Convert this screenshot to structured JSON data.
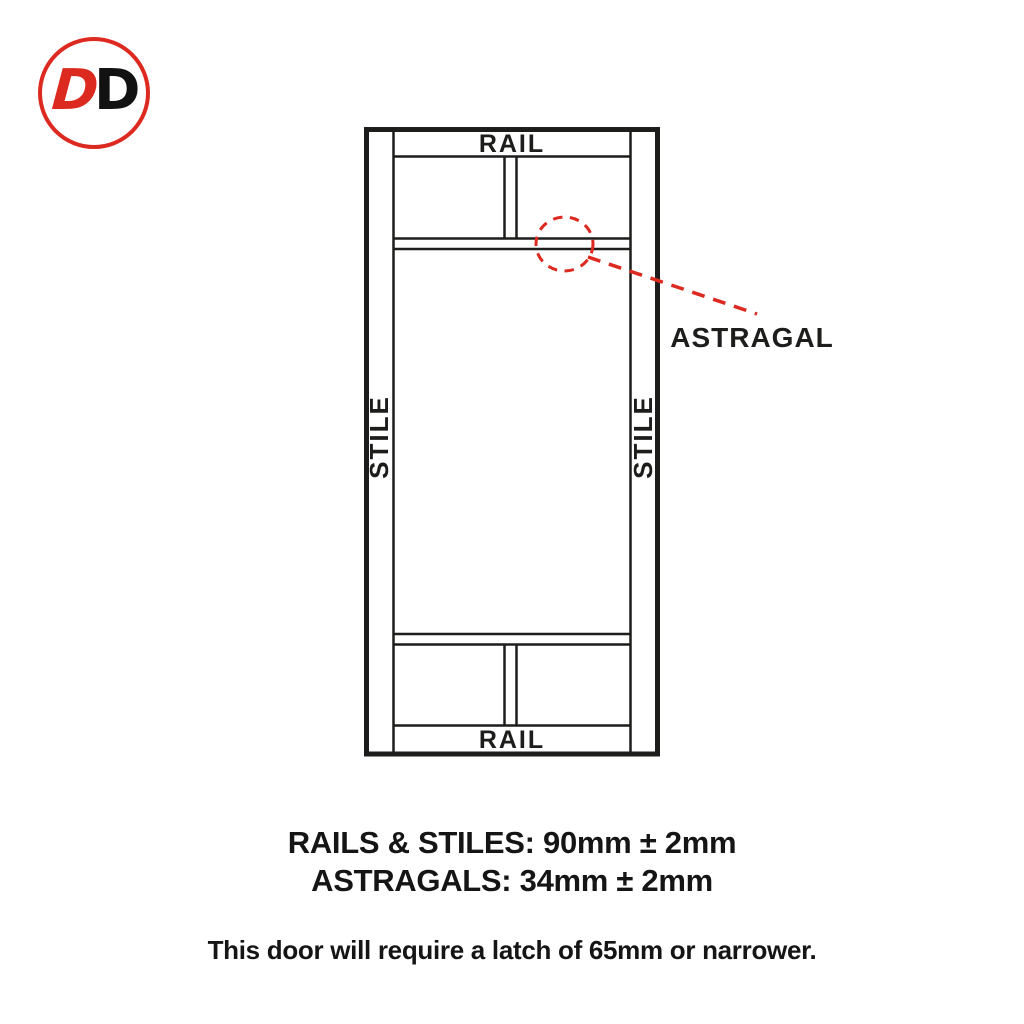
{
  "colors": {
    "ink": "#1d1d1b",
    "accent_red": "#dd2a20",
    "background": "#ffffff"
  },
  "logo": {
    "letter_red": "D",
    "letter_black": "D"
  },
  "diagram": {
    "top_rail_label": "RAIL",
    "bottom_rail_label": "RAIL",
    "left_stile_label": "STILE",
    "right_stile_label": "STILE",
    "astragal_label": "ASTRAGAL"
  },
  "specs": {
    "rails_stiles": "RAILS & STILES: 90mm ± 2mm",
    "astragals": "ASTRAGALS: 34mm ± 2mm"
  },
  "note": {
    "text": "This door will require a latch of 65mm or narrower."
  }
}
